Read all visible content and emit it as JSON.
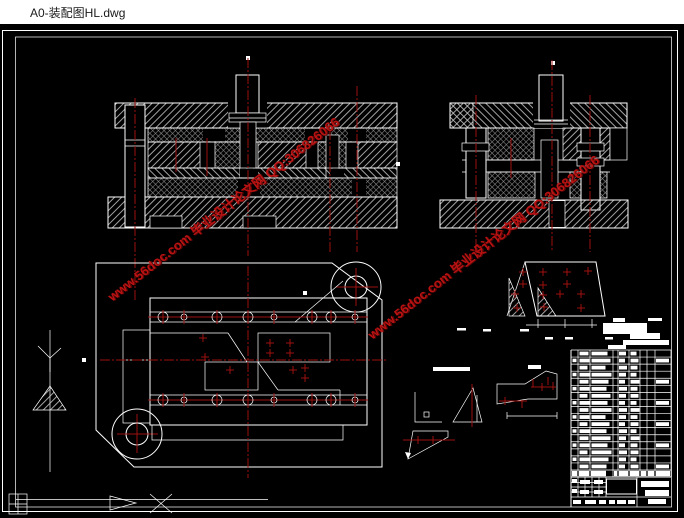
{
  "window": {
    "title": "A0-装配图HL.dwg"
  },
  "canvas": {
    "bg": "#000000",
    "line_color": "#ffffff",
    "hatch_color": "#cccccc",
    "centerline_color": "#9e1111"
  },
  "watermark": {
    "text": "www.56doc.com  毕业设计论文网  QQ:306826066",
    "color": "#c41414"
  },
  "plan": {
    "bolt_rows": [
      {
        "y": 317,
        "x1": 148,
        "x2": 368,
        "holes": [
          163,
          184,
          217,
          248,
          274,
          312,
          331,
          355
        ],
        "radii": [
          5,
          3,
          5,
          5,
          3,
          5,
          5,
          3
        ]
      },
      {
        "y": 400,
        "x1": 148,
        "x2": 368,
        "holes": [
          163,
          184,
          217,
          248,
          274,
          312,
          331,
          355
        ],
        "radii": [
          5,
          3,
          5,
          5,
          3,
          5,
          5,
          3
        ]
      }
    ],
    "center_marks": [
      [
        203,
        338
      ],
      [
        205,
        357
      ],
      [
        230,
        370
      ],
      [
        270,
        343
      ],
      [
        270,
        353
      ],
      [
        290,
        343
      ],
      [
        290,
        353
      ],
      [
        293,
        370
      ],
      [
        305,
        368
      ],
      [
        305,
        378
      ]
    ]
  },
  "strip": {
    "marks": [
      [
        523,
        272
      ],
      [
        543,
        272
      ],
      [
        567,
        272
      ],
      [
        588,
        271
      ],
      [
        523,
        284
      ],
      [
        543,
        285
      ],
      [
        567,
        284
      ],
      [
        515,
        294
      ],
      [
        543,
        295
      ],
      [
        560,
        294
      ],
      [
        581,
        294
      ],
      [
        517,
        308
      ],
      [
        544,
        307
      ],
      [
        581,
        308
      ]
    ]
  },
  "notes": {
    "bars": [
      [
        613,
        318,
        12,
        4
      ],
      [
        648,
        318,
        14,
        3
      ],
      [
        603,
        323,
        44,
        11
      ],
      [
        630,
        333,
        30,
        6
      ],
      [
        623,
        340,
        46,
        5
      ],
      [
        608,
        345,
        18,
        4
      ]
    ],
    "dashes": [
      [
        457,
        328,
        9
      ],
      [
        483,
        329,
        8
      ],
      [
        520,
        329,
        9
      ],
      [
        545,
        337,
        8
      ],
      [
        565,
        337,
        8
      ],
      [
        605,
        337,
        8
      ]
    ]
  },
  "title_block": {
    "columns": [
      571,
      578,
      590,
      613,
      618,
      629,
      640,
      647,
      655,
      671
    ],
    "top": 350,
    "row_h": 7.06,
    "rows": [
      [
        9,
        16,
        7,
        6,
        0
      ],
      [
        10,
        19,
        6,
        8,
        1
      ],
      [
        8,
        14,
        8,
        7,
        0
      ],
      [
        11,
        20,
        7,
        6,
        0
      ],
      [
        9,
        17,
        6,
        9,
        1
      ],
      [
        10,
        15,
        8,
        7,
        0
      ],
      [
        8,
        19,
        7,
        8,
        0
      ],
      [
        11,
        16,
        6,
        6,
        1
      ],
      [
        9,
        20,
        8,
        9,
        0
      ],
      [
        10,
        14,
        7,
        7,
        0
      ],
      [
        8,
        18,
        6,
        8,
        1
      ],
      [
        11,
        15,
        8,
        6,
        0
      ],
      [
        9,
        19,
        7,
        9,
        0
      ],
      [
        10,
        16,
        6,
        7,
        1
      ],
      [
        8,
        20,
        8,
        8,
        0
      ],
      [
        11,
        17,
        7,
        6,
        0
      ],
      [
        9,
        15,
        6,
        8,
        1
      ]
    ],
    "header_chips": [
      [
        572,
        5
      ],
      [
        579,
        10
      ],
      [
        591,
        15
      ],
      [
        614,
        3
      ],
      [
        619,
        9
      ],
      [
        630,
        9
      ],
      [
        641,
        5
      ],
      [
        648,
        6
      ],
      [
        656,
        14
      ]
    ],
    "bottom_chips": [
      [
        572,
        479,
        5,
        4
      ],
      [
        580,
        480,
        10,
        4
      ],
      [
        594,
        480,
        9,
        4
      ],
      [
        572,
        489,
        5,
        4
      ],
      [
        580,
        490,
        9,
        4
      ],
      [
        594,
        490,
        9,
        4
      ],
      [
        573,
        500,
        8,
        4
      ],
      [
        585,
        500,
        11,
        4
      ],
      [
        599,
        500,
        7,
        4
      ],
      [
        609,
        500,
        6,
        4
      ],
      [
        617,
        500,
        9,
        4
      ],
      [
        628,
        500,
        7,
        4
      ]
    ],
    "right_bars": [
      [
        641,
        481,
        28,
        6
      ],
      [
        645,
        490,
        24,
        6
      ],
      [
        648,
        499,
        18,
        5
      ]
    ]
  }
}
